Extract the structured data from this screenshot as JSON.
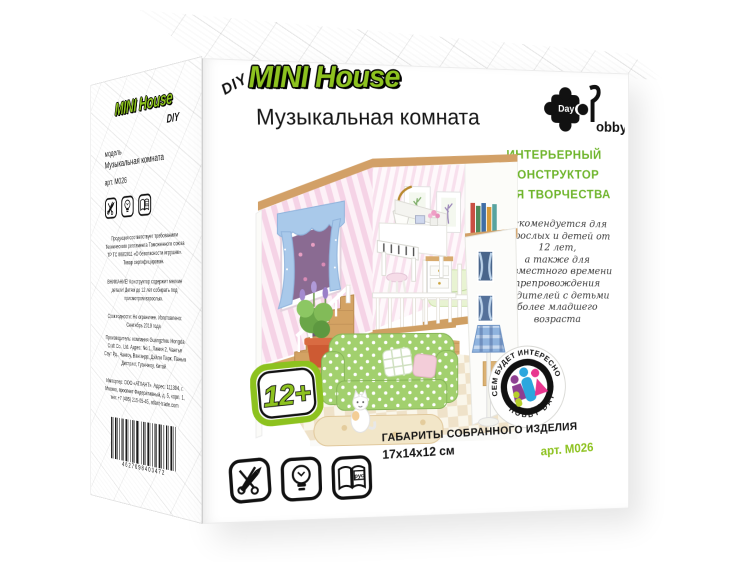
{
  "colors": {
    "brand_green": "#8dc21f",
    "headline_green": "#6fb52c",
    "trim_wood": "#d2a067",
    "sofa_green": "#a2d06e",
    "curtain_blue": "#a9c9ea",
    "figure_purple": "#8e3f92",
    "figure_blue": "#2ba7de",
    "figure_pink": "#e8368f",
    "figure_green": "#b6cf2a"
  },
  "front": {
    "diy": "DIY",
    "brand": "MINI House",
    "title": "Музыкальная комната",
    "logo": {
      "day": "Day",
      "hobby": "obby"
    },
    "headline_lines": [
      "Интерьерный",
      "конструктор",
      "для творчества"
    ],
    "recommend_lines": [
      "Рекомендуется для",
      "взрослых и детей от",
      "12 лет,",
      "а также для",
      "совместного времени",
      "препровождения",
      "родителей с детьми",
      "более младшего",
      "возраста"
    ],
    "age_badge": "12+",
    "dimensions_label": "Габариты собранного изделия",
    "dimensions_value": "17х14х12 см",
    "art_number": "арт. M026",
    "family_badge": {
      "arc_top": "ВСЕМ БУДЕТ ИНТЕРЕСНО!",
      "arc_bottom": "HOBBY DAY"
    },
    "book_icon_label": "рус"
  },
  "side": {
    "brand": "MINI House",
    "diy": "DIY",
    "model_label": "модель",
    "model_name": "Музыкальная комната",
    "art_number": "арт. M026",
    "legal": "Продукция соответствует требованиям Технического регламента Таможенного союза ТР ТС 008/2011 «О безопасности игрушек». Товар сертифицирован.",
    "warning": "ВНИМАНИЕ! Конструктор содержит мелкие детали! Детям до 12 лет собирать под присмотром взрослых.",
    "shelf_life": "Срок годности: Не ограничен. Изготовлено: Сентябрь 2019 года",
    "manufacturer": "Производитель: компания Guangzhou Hongda Craft Co., Ltd. Адрес: No.1, Линия 2, Чангъя Саут Рд., Чантоу, Вангандс, Дэйли Парк, Панью Дистрикт, Гуанчжоу, Китай",
    "importer": "Импортер: ООО «АТЛАНТ». Адрес: 111394, г. Москва, проспект Федеративный, д. 5, корп. 1, тел: +7 (495) 215-05-45, atlant-trade.com",
    "barcode_digits": "4627098403472"
  },
  "scene_items": [
    "striped-wallpaper",
    "window-with-blue-curtains",
    "grand-piano",
    "piano-stool",
    "wall-lamp",
    "picture-frames",
    "bookshelf",
    "loft-bed",
    "dresser",
    "stairs",
    "railing",
    "green-polka-sofa",
    "pillows",
    "rug",
    "plaid-floor-lamp",
    "potted-plant",
    "side-table",
    "cat-figure",
    "tile-floor",
    "wood-floor",
    "outer-facade"
  ]
}
